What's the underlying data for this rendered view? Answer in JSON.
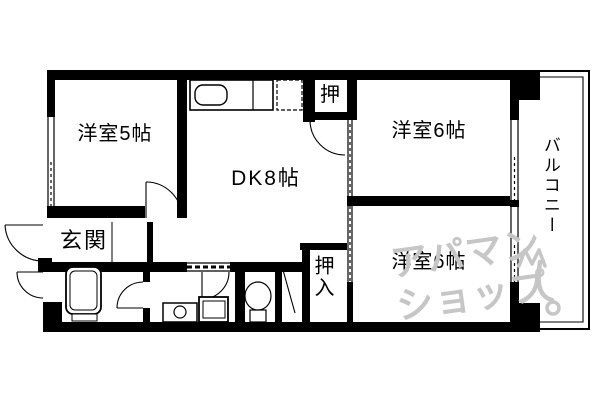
{
  "plan": {
    "rooms": {
      "western_room_5": {
        "label": "洋室5帖"
      },
      "dk": {
        "label": "DK8帖"
      },
      "western_room_6_upper": {
        "label": "洋室6帖"
      },
      "western_room_6_lower": {
        "label": "洋室6帖"
      },
      "entrance": {
        "label": "玄関"
      },
      "closet_upper": {
        "label": "押"
      },
      "closet_lower": {
        "label": "押入"
      },
      "balcony": {
        "label": "バルコニー"
      }
    },
    "fixtures": [
      "kitchen-sink",
      "refrigerator-space",
      "bathtub",
      "washing-machine-pan",
      "washbasin",
      "toilet"
    ],
    "colors": {
      "wall": "#000000",
      "background": "#ffffff",
      "watermark": "#c6c6c6"
    }
  },
  "watermark": {
    "line1": "アパマン",
    "line2": "ショップ"
  }
}
